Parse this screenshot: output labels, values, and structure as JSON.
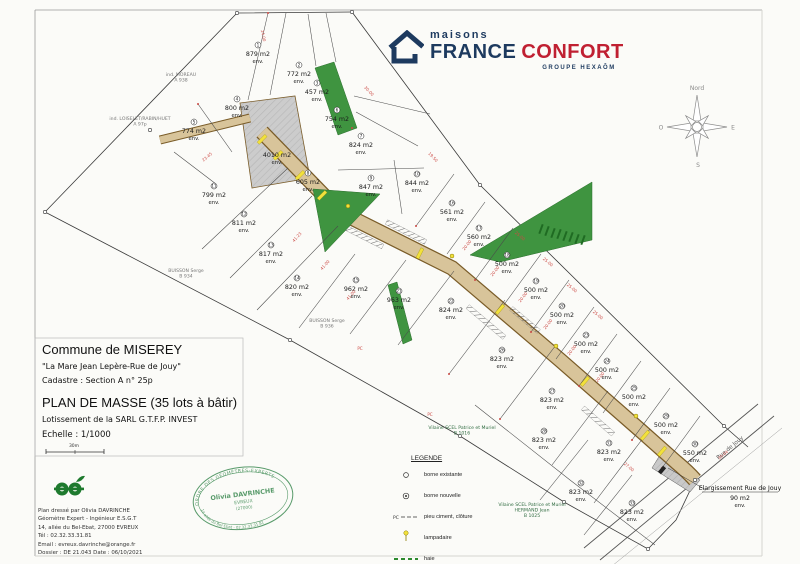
{
  "logo": {
    "brand_top": "maisons",
    "brand_main_1": "FRANCE",
    "brand_main_2": "CONFORT",
    "brand_sub": "GROUPE HEXAÔM"
  },
  "title_block": {
    "commune": "Commune de MISEREY",
    "subtitle": "\"La Mare Jean Lepère-Rue de Jouy\"",
    "cadastre": "Cadastre : Section A n° 25p",
    "plan_title": "PLAN DE MASSE (35 lots à bâtir)",
    "lotissement": "Lotissement de la SARL G.T.F.P. INVEST",
    "echelle": "Echelle : 1/1000",
    "scale_label": "30m"
  },
  "surveyor": {
    "line1": "Plan dressé par Olivia DAVRINCHE",
    "line2": "Géomètre Expert - Ingénieur E.S.G.T",
    "line3": "14, allée du Bel-Ebat, 27000 EVREUX",
    "line4": "Tél : 02.32.33.31.81",
    "line5": "Email : evreux.davrinche@orange.fr",
    "line6": "Dossier : DE 21.043      Date : 06/10/2021"
  },
  "stamp": {
    "arc_top": "ORDRE DES GÉOMÈTRES-EXPERTS",
    "name": "Olivia DAVRINCHE",
    "city": "EVREUX",
    "cp": "(27000)",
    "arc_bottom": "14 allée du Bel-Ebat - 02.32.33.31.81"
  },
  "legend": {
    "title": "LEGENDE",
    "items": [
      {
        "label": "borne existante"
      },
      {
        "label": "borne nouvelle"
      },
      {
        "label": "pieu ciment, clôture",
        "prefix": "PC"
      },
      {
        "label": "lampadaire"
      },
      {
        "label": "haie"
      }
    ]
  },
  "compass": {
    "north": "Nord",
    "west": "O",
    "east": "E",
    "south": "S"
  },
  "plan": {
    "street_label": "Rue de Jouy",
    "road_note": {
      "title": "Elargissement Rue de Jouy",
      "area": "90 m2",
      "env": "env."
    },
    "colors": {
      "green": "#3f9440",
      "road_tan": "#d8c49a",
      "road_edge": "#7a5c28",
      "yellow": "#f2e13c",
      "red": "#cc4a45",
      "gray_parcel": "#cccccc",
      "stamp_green": "#3c8a52",
      "logo_navy": "#1d3a5f",
      "logo_red": "#c02032"
    },
    "lots": [
      {
        "num": "1",
        "area": "879 m2",
        "env": "env.",
        "x": 258,
        "y": 56
      },
      {
        "num": "2",
        "area": "772 m2",
        "env": "env.",
        "x": 299,
        "y": 76
      },
      {
        "num": "3",
        "area": "457 m2",
        "env": "env.",
        "x": 317,
        "y": 94
      },
      {
        "num": "4",
        "area": "800 m2",
        "env": "env.",
        "x": 237,
        "y": 110
      },
      {
        "num": "5",
        "area": "774 m2",
        "env": "env.",
        "x": 194,
        "y": 133
      },
      {
        "num": "6",
        "area": "754 m2",
        "env": "env.",
        "x": 337,
        "y": 121
      },
      {
        "num": "7",
        "area": "824 m2",
        "env": "env.",
        "x": 361,
        "y": 147
      },
      {
        "num": "8",
        "area": "605 m2",
        "env": "env.",
        "x": 308,
        "y": 184
      },
      {
        "num": "9",
        "area": "847 m2",
        "env": "env.",
        "x": 371,
        "y": 189
      },
      {
        "num": "10",
        "area": "844 m2",
        "env": "env.",
        "x": 417,
        "y": 185
      },
      {
        "num": "11",
        "area": "799 m2",
        "env": "env.",
        "x": 214,
        "y": 197
      },
      {
        "num": "12",
        "area": "811 m2",
        "env": "env.",
        "x": 244,
        "y": 225
      },
      {
        "num": "13",
        "area": "817 m2",
        "env": "env.",
        "x": 271,
        "y": 256
      },
      {
        "num": "14",
        "area": "820 m2",
        "env": "env.",
        "x": 297,
        "y": 289
      },
      {
        "num": "15",
        "area": "962 m2",
        "env": "env.",
        "x": 356,
        "y": 291
      },
      {
        "num": "16",
        "area": "561 m2",
        "env": "env.",
        "x": 452,
        "y": 214
      },
      {
        "num": "17",
        "area": "560 m2",
        "env": "env.",
        "x": 479,
        "y": 239
      },
      {
        "num": "18",
        "area": "500 m2",
        "env": "env.",
        "x": 507,
        "y": 266
      },
      {
        "num": "19",
        "area": "500 m2",
        "env": "env.",
        "x": 536,
        "y": 292
      },
      {
        "num": "20",
        "area": "500 m2",
        "env": "env.",
        "x": 562,
        "y": 317
      },
      {
        "num": "21",
        "area": "963 m2",
        "env": "env.",
        "x": 399,
        "y": 302
      },
      {
        "num": "22",
        "area": "824 m2",
        "env": "env.",
        "x": 451,
        "y": 312
      },
      {
        "num": "23",
        "area": "500 m2",
        "env": "env.",
        "x": 586,
        "y": 346
      },
      {
        "num": "24",
        "area": "500 m2",
        "env": "env.",
        "x": 607,
        "y": 372
      },
      {
        "num": "25",
        "area": "500 m2",
        "env": "env.",
        "x": 634,
        "y": 399
      },
      {
        "num": "26",
        "area": "823 m2",
        "env": "env.",
        "x": 502,
        "y": 361
      },
      {
        "num": "27",
        "area": "823 m2",
        "env": "env.",
        "x": 552,
        "y": 402
      },
      {
        "num": "28",
        "area": "823 m2",
        "env": "env.",
        "x": 544,
        "y": 442
      },
      {
        "num": "29",
        "area": "500 m2",
        "env": "env.",
        "x": 666,
        "y": 427
      },
      {
        "num": "30",
        "area": "550 m2",
        "env": "env.",
        "x": 695,
        "y": 455
      },
      {
        "num": "31",
        "area": "823 m2",
        "env": "env.",
        "x": 609,
        "y": 454
      },
      {
        "num": "32",
        "area": "823 m2",
        "env": "env.",
        "x": 581,
        "y": 494
      },
      {
        "num": "33",
        "area": "823 m2",
        "env": "env.",
        "x": 632,
        "y": 514
      },
      {
        "num": "",
        "area": "4010 m2",
        "env": "env.",
        "x": 277,
        "y": 157
      }
    ],
    "owners": [
      {
        "lines": [
          "ind. MOREAU",
          "A 938"
        ],
        "x": 181,
        "y": 76
      },
      {
        "lines": [
          "ind. LOISELET/RABIN/HUET",
          "A 97p"
        ],
        "x": 140,
        "y": 120
      },
      {
        "lines": [
          "BUISSON Serge",
          "B 934"
        ],
        "x": 186,
        "y": 272
      },
      {
        "lines": [
          "BUISSON Serge",
          "B 936"
        ],
        "x": 327,
        "y": 322
      },
      {
        "lines": [
          "Vilaine SCEL Patrice et Muriel",
          "B 1016"
        ],
        "x": 462,
        "y": 429,
        "green": true
      },
      {
        "lines": [
          "Vilaine SCEL Patrice et Muriel",
          "HERMAND Jean",
          "B 1025"
        ],
        "x": 532,
        "y": 506,
        "green": true
      }
    ],
    "dims": [
      {
        "v": "20.00",
        "x": 468,
        "y": 246,
        "a": -52
      },
      {
        "v": "20.00",
        "x": 496,
        "y": 272,
        "a": -52
      },
      {
        "v": "20.00",
        "x": 524,
        "y": 298,
        "a": -52
      },
      {
        "v": "20.00",
        "x": 549,
        "y": 325,
        "a": -52
      },
      {
        "v": "20.00",
        "x": 573,
        "y": 351,
        "a": -52
      },
      {
        "v": "20.00",
        "x": 601,
        "y": 378,
        "a": -52
      },
      {
        "v": "25.00",
        "x": 519,
        "y": 237,
        "a": 40
      },
      {
        "v": "25.00",
        "x": 547,
        "y": 263,
        "a": 40
      },
      {
        "v": "25.00",
        "x": 571,
        "y": 289,
        "a": 40
      },
      {
        "v": "25.00",
        "x": 597,
        "y": 316,
        "a": 40
      },
      {
        "v": "41.23",
        "x": 298,
        "y": 238,
        "a": -48
      },
      {
        "v": "41.00",
        "x": 326,
        "y": 266,
        "a": -48
      },
      {
        "v": "41.00",
        "x": 352,
        "y": 296,
        "a": -48
      },
      {
        "v": "24.00",
        "x": 262,
        "y": 36,
        "a": 78
      },
      {
        "v": "30.00",
        "x": 368,
        "y": 92,
        "a": 46
      },
      {
        "v": "23.45",
        "x": 208,
        "y": 158,
        "a": -40
      },
      {
        "v": "19.50",
        "x": 432,
        "y": 158,
        "a": 46
      },
      {
        "v": "27.00",
        "x": 628,
        "y": 468,
        "a": 40
      },
      {
        "v": "20.04",
        "x": 724,
        "y": 456,
        "a": -41
      },
      {
        "v": "PC",
        "x": 430,
        "y": 416,
        "a": 0
      },
      {
        "v": "PC",
        "x": 360,
        "y": 350,
        "a": 0
      }
    ]
  }
}
